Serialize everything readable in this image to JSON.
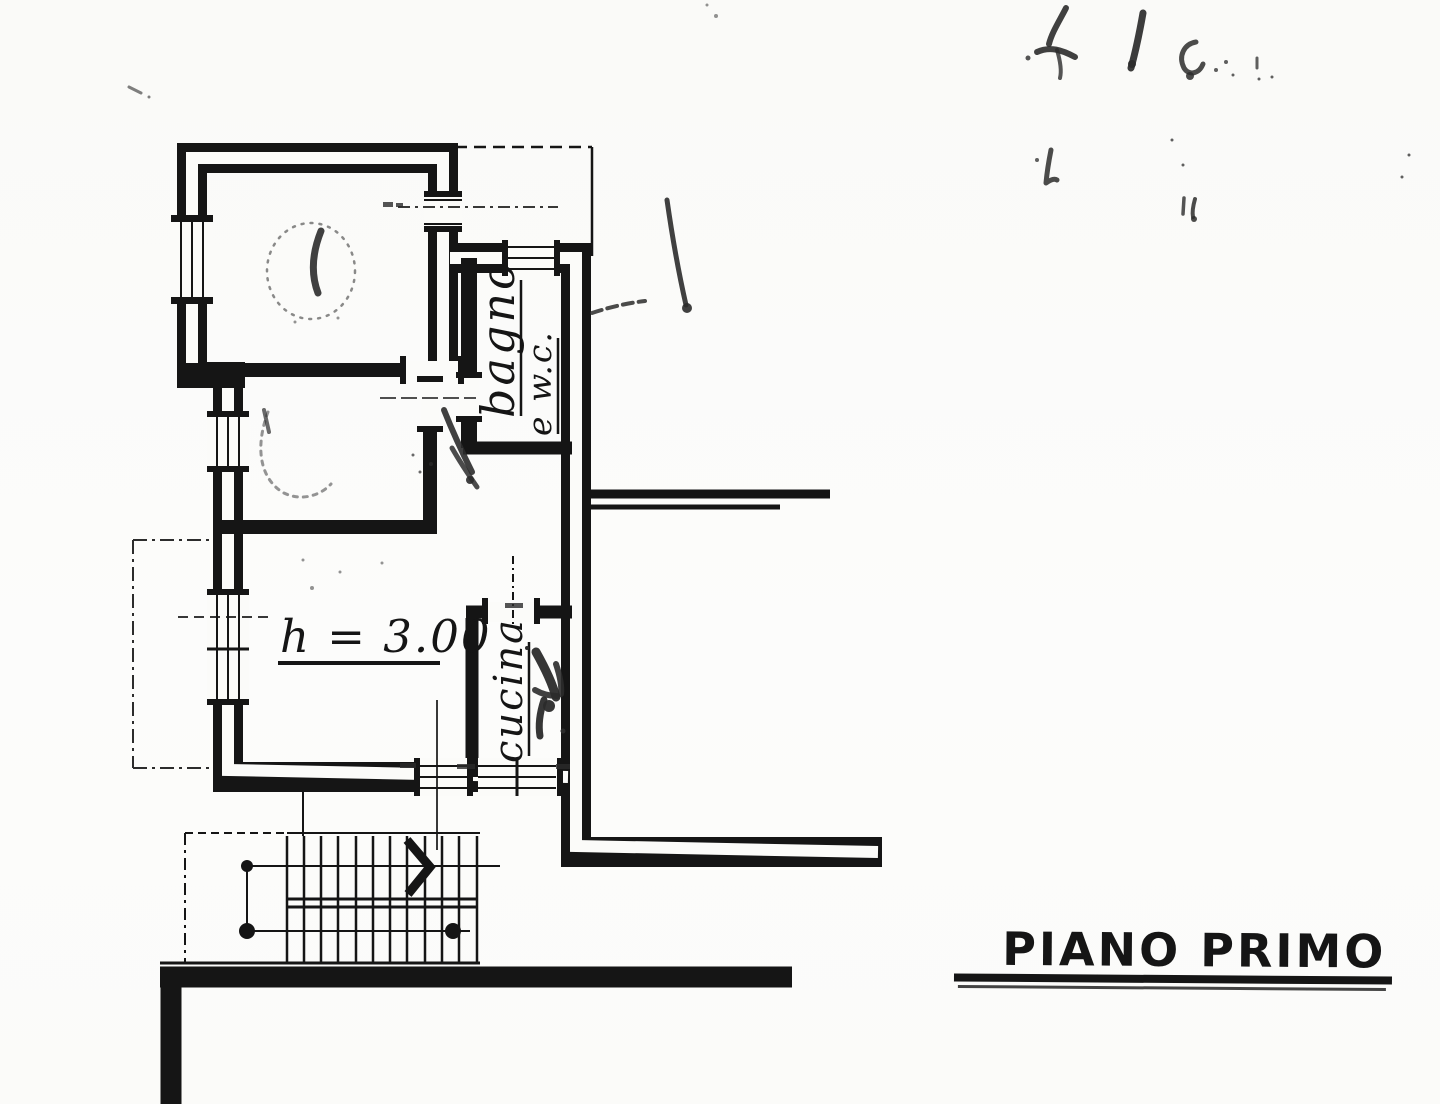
{
  "colors": {
    "paper": "#fbfbf9",
    "ink": "#151515",
    "pencil": "#2b2b2b"
  },
  "annotations": {
    "bathroom_line1": "bagno",
    "bathroom_line2": "e w.c.",
    "kitchen": "cucina",
    "height_note": "h = 3.00",
    "floor_title": "PIANO PRIMO"
  }
}
